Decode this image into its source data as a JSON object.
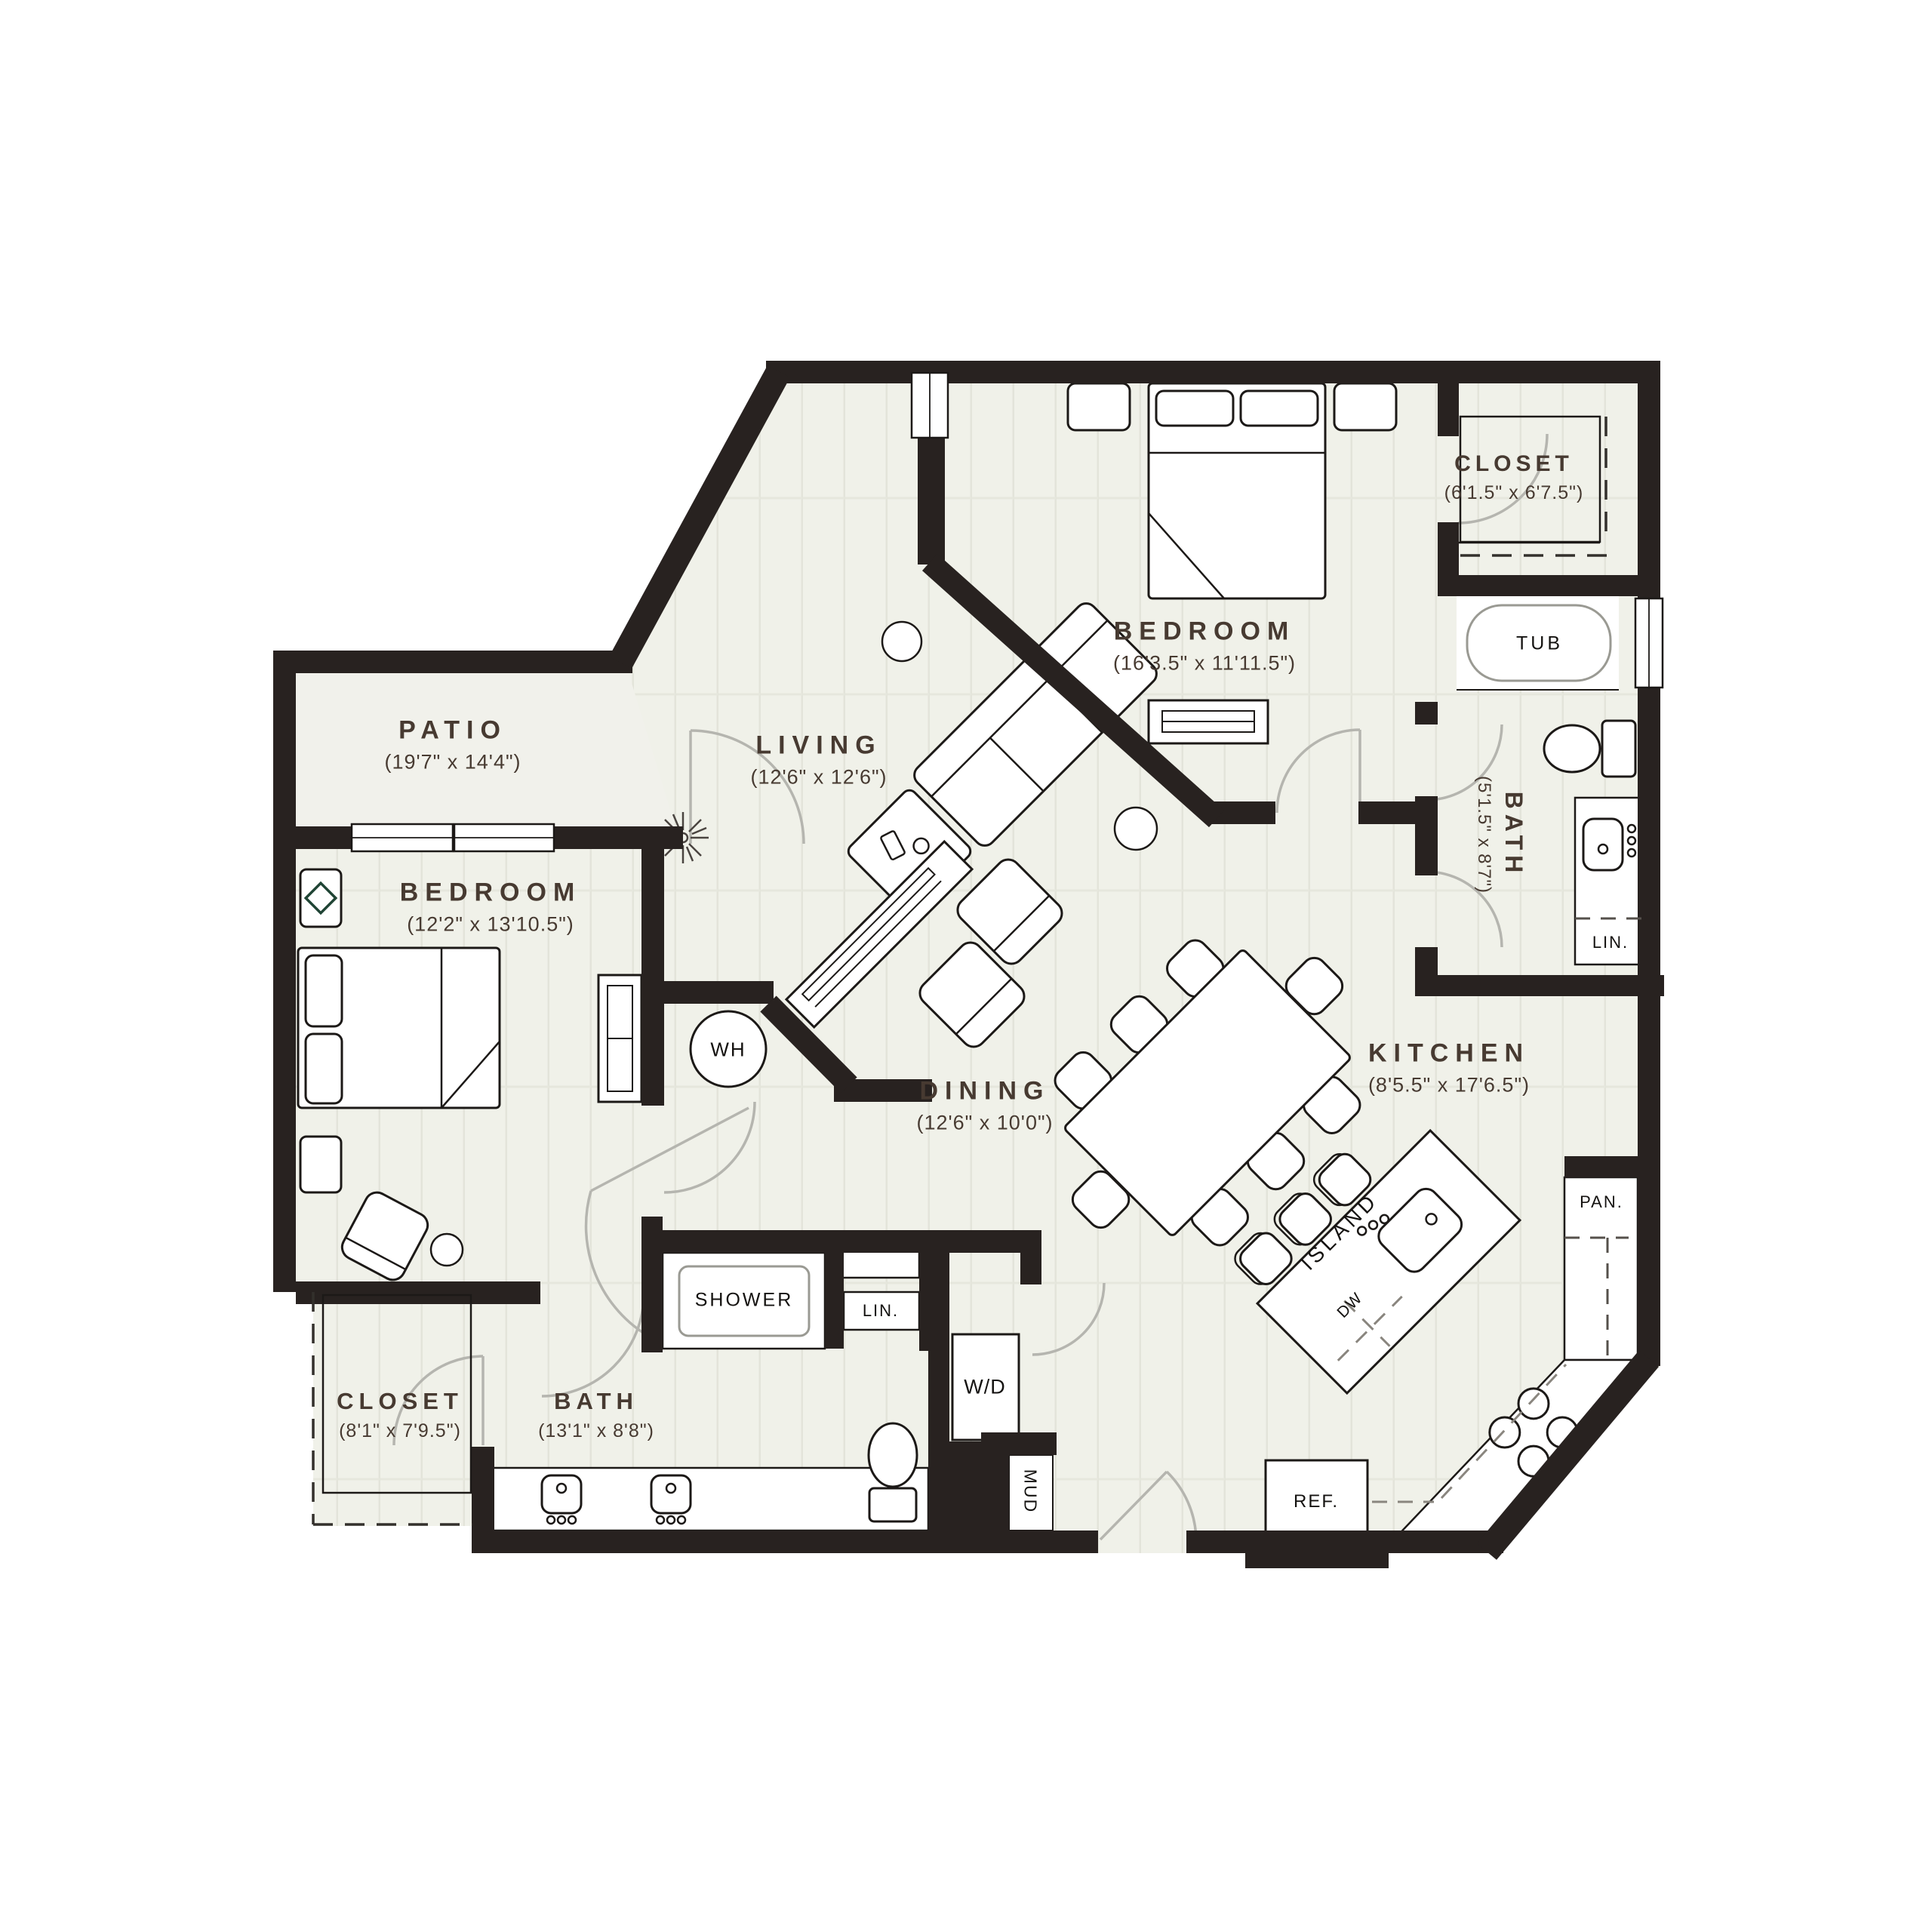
{
  "colors": {
    "wall": "#282220",
    "floor": "#f0f1e9",
    "plank_line": "#e3e4da",
    "room_label": "#473a31",
    "fixture_label": "#141210",
    "door_arc": "#b5b5af",
    "accent_green": "#1f4434"
  },
  "rooms": {
    "patio": {
      "name": "PATIO",
      "dims": "(19'7\" x 14'4\")"
    },
    "living": {
      "name": "LIVING",
      "dims": "(12'6\" x 12'6\")"
    },
    "bedroom_top": {
      "name": "BEDROOM",
      "dims": "(16'3.5\" x 11'11.5\")"
    },
    "closet_top": {
      "name": "CLOSET",
      "dims": "(6'1.5\" x 6'7.5\")"
    },
    "bath_right": {
      "name": "BATH",
      "dims": "(5'1.5\" x 8'7\")"
    },
    "bedroom_left": {
      "name": "BEDROOM",
      "dims": "(12'2\" x 13'10.5\")"
    },
    "dining": {
      "name": "DINING",
      "dims": "(12'6\" x 10'0\")"
    },
    "kitchen": {
      "name": "KITCHEN",
      "dims": "(8'5.5\" x 17'6.5\")"
    },
    "closet_bottom": {
      "name": "CLOSET",
      "dims": "(8'1\" x 7'9.5\")"
    },
    "bath_bottom": {
      "name": "BATH",
      "dims": "(13'1\" x 8'8\")"
    }
  },
  "fixtures": {
    "tub": "TUB",
    "water_heater": "WH",
    "shower": "SHOWER",
    "linen_right": "LIN.",
    "linen_mid": "LIN.",
    "washer_dryer": "W/D",
    "mud": "MUD",
    "island": "ISLAND",
    "dishwasher": "DW",
    "pantry": "PAN.",
    "refrigerator": "REF."
  }
}
